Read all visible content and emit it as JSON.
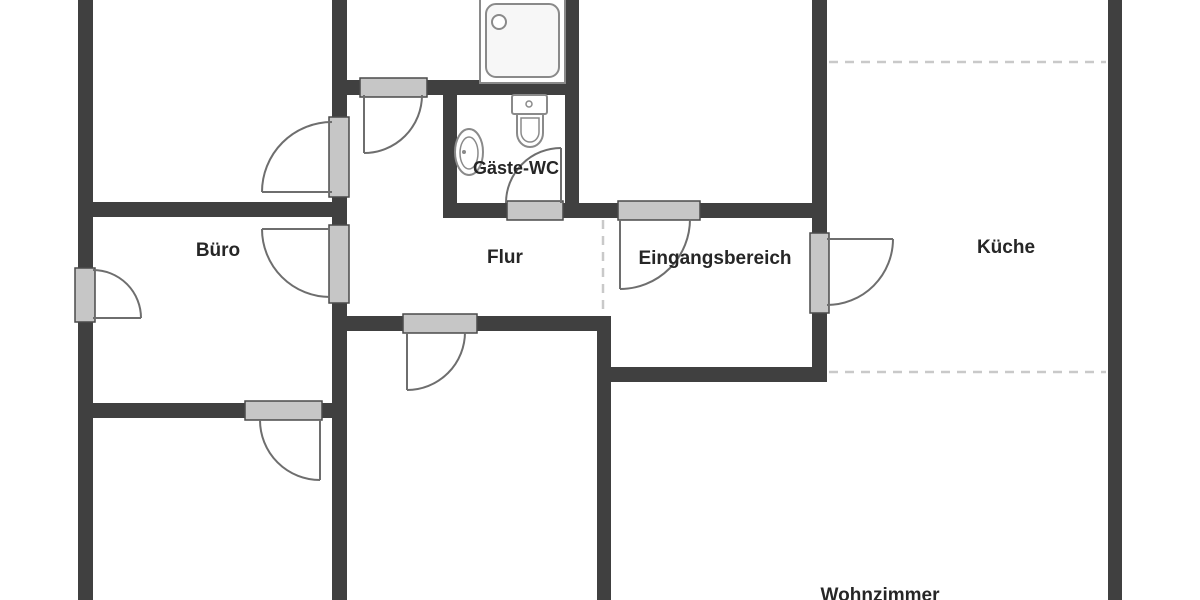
{
  "canvas": {
    "width": 1200,
    "height": 600,
    "background": "#ffffff"
  },
  "colors": {
    "wall": "#404040",
    "jamb_fill": "#c6c6c6",
    "jamb_border": "#4a4a4a",
    "door_swing": "#6e6e6e",
    "dashed_boundary": "#c9c9c9",
    "fixture_outline": "#8a8a8a",
    "fixture_fill": "#ffffff",
    "shower_tray_fill": "#f7f7f7",
    "label_text": "#262626"
  },
  "rooms": [
    {
      "id": "buero",
      "label": "Büro",
      "label_x": 218,
      "label_y": 251,
      "label_size": 19
    },
    {
      "id": "flur",
      "label": "Flur",
      "label_x": 505,
      "label_y": 258,
      "label_size": 19
    },
    {
      "id": "gaeste_wc",
      "label": "Gäste-WC",
      "label_x": 516,
      "label_y": 169,
      "label_size": 18
    },
    {
      "id": "eingangsbereich",
      "label": "Eingangsbereich",
      "label_x": 715,
      "label_y": 259,
      "label_size": 19
    },
    {
      "id": "kueche",
      "label": "Küche",
      "label_x": 1006,
      "label_y": 248,
      "label_size": 19
    },
    {
      "id": "wohnzimmer",
      "label": "Wohnzimmer",
      "label_x": 880,
      "label_y": 596,
      "label_size": 19
    }
  ],
  "floorplan": {
    "walls": [
      {
        "x": 78,
        "y": 0,
        "w": 15,
        "h": 268
      },
      {
        "x": 78,
        "y": 322,
        "w": 15,
        "h": 278
      },
      {
        "x": 332,
        "y": 0,
        "w": 15,
        "h": 117
      },
      {
        "x": 332,
        "y": 197,
        "w": 15,
        "h": 28
      },
      {
        "x": 332,
        "y": 303,
        "w": 15,
        "h": 297
      },
      {
        "x": 78,
        "y": 202,
        "w": 269,
        "h": 15
      },
      {
        "x": 93,
        "y": 403,
        "w": 152,
        "h": 15
      },
      {
        "x": 322,
        "y": 403,
        "w": 25,
        "h": 15
      },
      {
        "x": 347,
        "y": 80,
        "w": 13,
        "h": 15
      },
      {
        "x": 427,
        "y": 80,
        "w": 152,
        "h": 15
      },
      {
        "x": 443,
        "y": 95,
        "w": 14,
        "h": 122
      },
      {
        "x": 565,
        "y": 0,
        "w": 14,
        "h": 217
      },
      {
        "x": 443,
        "y": 203,
        "w": 64,
        "h": 15
      },
      {
        "x": 563,
        "y": 203,
        "w": 55,
        "h": 15
      },
      {
        "x": 700,
        "y": 203,
        "w": 112,
        "h": 15
      },
      {
        "x": 812,
        "y": 0,
        "w": 15,
        "h": 233
      },
      {
        "x": 812,
        "y": 313,
        "w": 15,
        "h": 62
      },
      {
        "x": 347,
        "y": 316,
        "w": 56,
        "h": 15
      },
      {
        "x": 477,
        "y": 316,
        "w": 134,
        "h": 15
      },
      {
        "x": 597,
        "y": 316,
        "w": 14,
        "h": 284
      },
      {
        "x": 611,
        "y": 367,
        "w": 216,
        "h": 15
      },
      {
        "x": 1108,
        "y": 0,
        "w": 14,
        "h": 600
      }
    ],
    "door_jambs": [
      {
        "x": 75,
        "y": 268,
        "w": 20,
        "h": 54
      },
      {
        "x": 329,
        "y": 117,
        "w": 20,
        "h": 80
      },
      {
        "x": 329,
        "y": 225,
        "w": 20,
        "h": 78
      },
      {
        "x": 360,
        "y": 78,
        "w": 67,
        "h": 19
      },
      {
        "x": 507,
        "y": 201,
        "w": 56,
        "h": 19
      },
      {
        "x": 618,
        "y": 201,
        "w": 82,
        "h": 19
      },
      {
        "x": 810,
        "y": 233,
        "w": 19,
        "h": 80
      },
      {
        "x": 403,
        "y": 314,
        "w": 74,
        "h": 19
      },
      {
        "x": 245,
        "y": 401,
        "w": 77,
        "h": 19
      }
    ],
    "door_swings": [
      {
        "hinge_x": 93,
        "hinge_y": 318,
        "radius": 48,
        "from_deg": -90,
        "to_deg": 0,
        "sweep": 1
      },
      {
        "hinge_x": 332,
        "hinge_y": 192,
        "radius": 70,
        "from_deg": -90,
        "to_deg": 180,
        "sweep": 0
      },
      {
        "hinge_x": 330,
        "hinge_y": 229,
        "radius": 68,
        "from_deg": 90,
        "to_deg": 180,
        "sweep": 1
      },
      {
        "hinge_x": 364,
        "hinge_y": 95,
        "radius": 58,
        "from_deg": 0,
        "to_deg": 90,
        "sweep": 1
      },
      {
        "hinge_x": 561,
        "hinge_y": 203,
        "radius": 55,
        "from_deg": 180,
        "to_deg": 270,
        "sweep": 1
      },
      {
        "hinge_x": 620,
        "hinge_y": 219,
        "radius": 70,
        "from_deg": 0,
        "to_deg": 90,
        "sweep": 1
      },
      {
        "hinge_x": 827,
        "hinge_y": 239,
        "radius": 66,
        "from_deg": 90,
        "to_deg": 0,
        "sweep": 0
      },
      {
        "hinge_x": 407,
        "hinge_y": 332,
        "radius": 58,
        "from_deg": 0,
        "to_deg": 90,
        "sweep": 1
      },
      {
        "hinge_x": 320,
        "hinge_y": 420,
        "radius": 60,
        "from_deg": 180,
        "to_deg": 90,
        "sweep": 0
      }
    ],
    "dashed_boundaries": [
      {
        "x1": 829,
        "y1": 62,
        "x2": 1106,
        "y2": 62
      },
      {
        "x1": 829,
        "y1": 372,
        "x2": 1106,
        "y2": 372
      },
      {
        "x1": 603,
        "y1": 220,
        "x2": 603,
        "y2": 314
      }
    ],
    "fixtures": {
      "shower": {
        "outer": {
          "x": 480,
          "y": -6,
          "w": 85,
          "h": 89
        },
        "tray": {
          "x": 486,
          "y": 4,
          "w": 73,
          "h": 73,
          "rx": 10
        },
        "drain": {
          "cx": 499,
          "cy": 22,
          "r": 7
        }
      },
      "toilet": {
        "tank": {
          "x": 512,
          "y": 95,
          "w": 35,
          "h": 19,
          "rx": 2
        },
        "button": {
          "cx": 529,
          "cy": 104,
          "r": 3
        },
        "bowl_outer": {
          "x": 517,
          "y": 114,
          "w": 26,
          "top": 19,
          "r": 13
        },
        "bowl_inner": {
          "x": 521,
          "y": 118,
          "w": 18,
          "top": 14,
          "r": 9
        }
      },
      "sink": {
        "outer": {
          "cx": 469,
          "cy": 152,
          "rx": 14,
          "ry": 23
        },
        "inner": {
          "cx": 469,
          "cy": 153,
          "rx": 9,
          "ry": 16
        },
        "dot": {
          "cx": 464,
          "cy": 152,
          "r": 2
        }
      }
    }
  }
}
